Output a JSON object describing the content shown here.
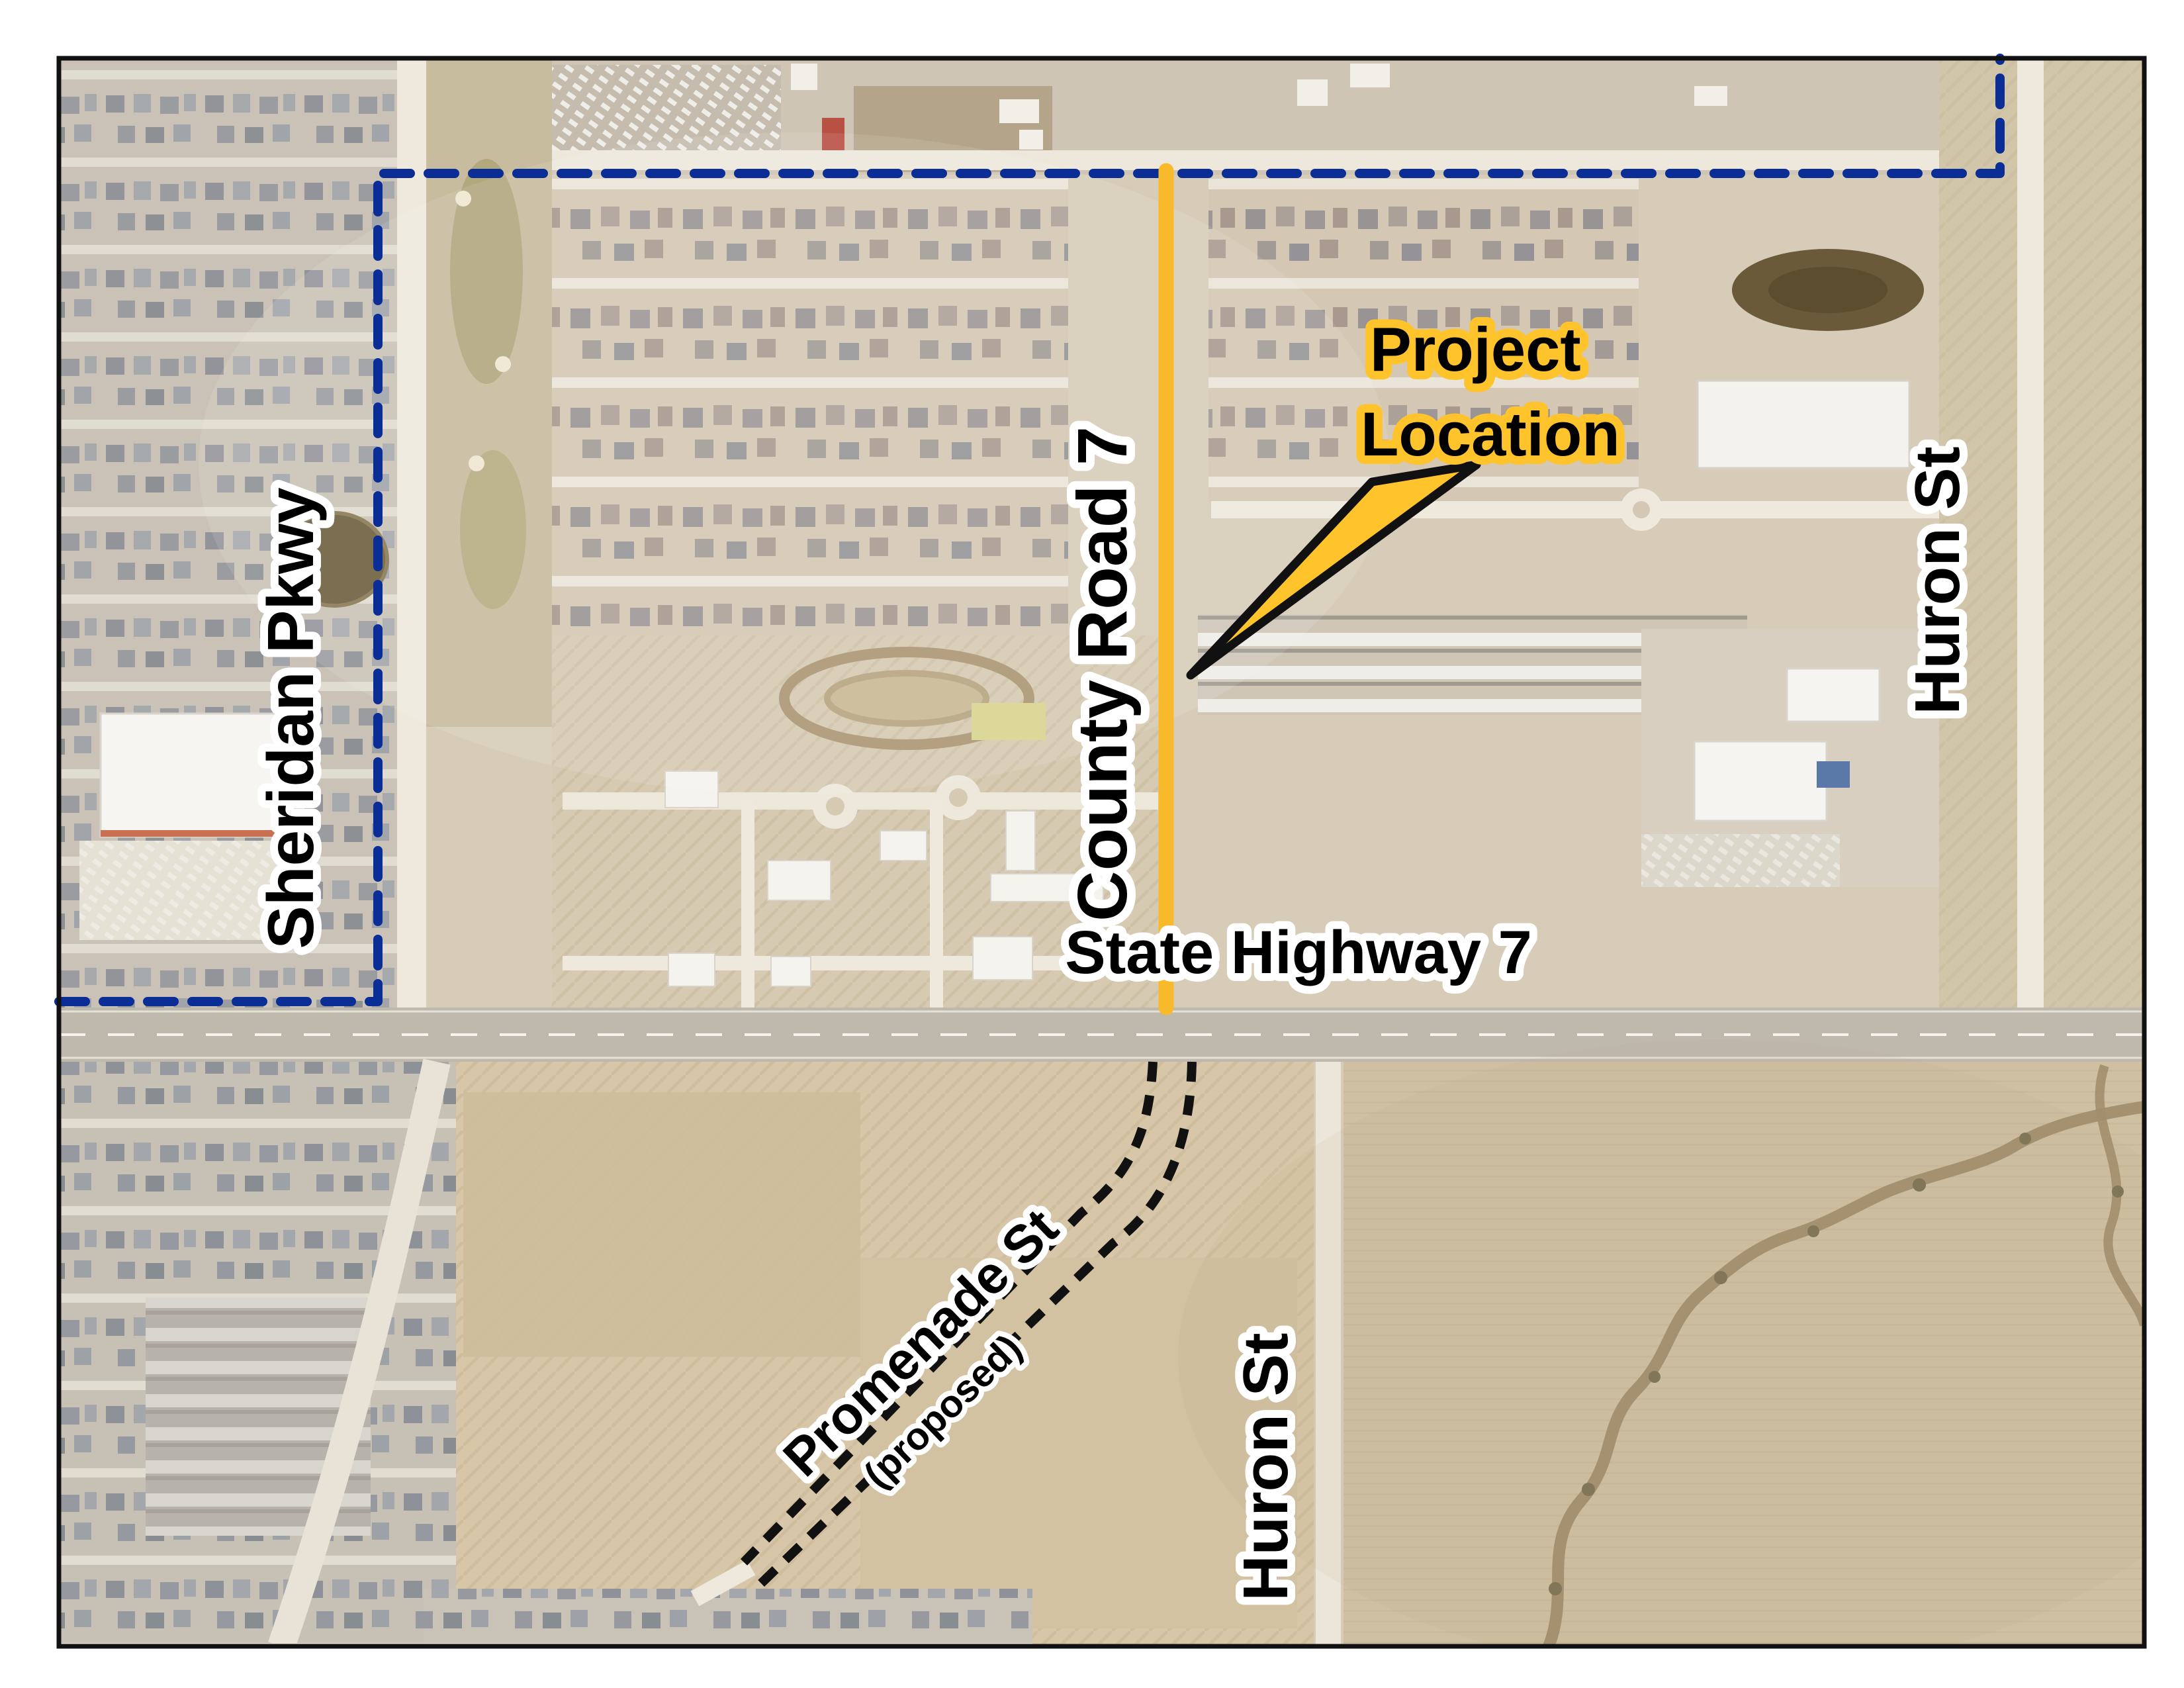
{
  "labels": {
    "project_location_line1": "Project",
    "project_location_line2": "Location",
    "county_road": "County Road 7",
    "state_highway": "State Highway 7",
    "sheridan_pkwy": "Sheridan Pkwy",
    "huron_st_east": "Huron St",
    "huron_st_south": "Huron St",
    "promenade_st": "Promenade St",
    "promenade_status": "(proposed)"
  },
  "colors": {
    "boundary_blue": "#0B2D96",
    "highlight_yellow": "#F8BA2B",
    "callout_yellow": "#FFC32B",
    "halo_white": "#FFFFFF",
    "text_black": "#000000",
    "border_black": "#111111"
  }
}
